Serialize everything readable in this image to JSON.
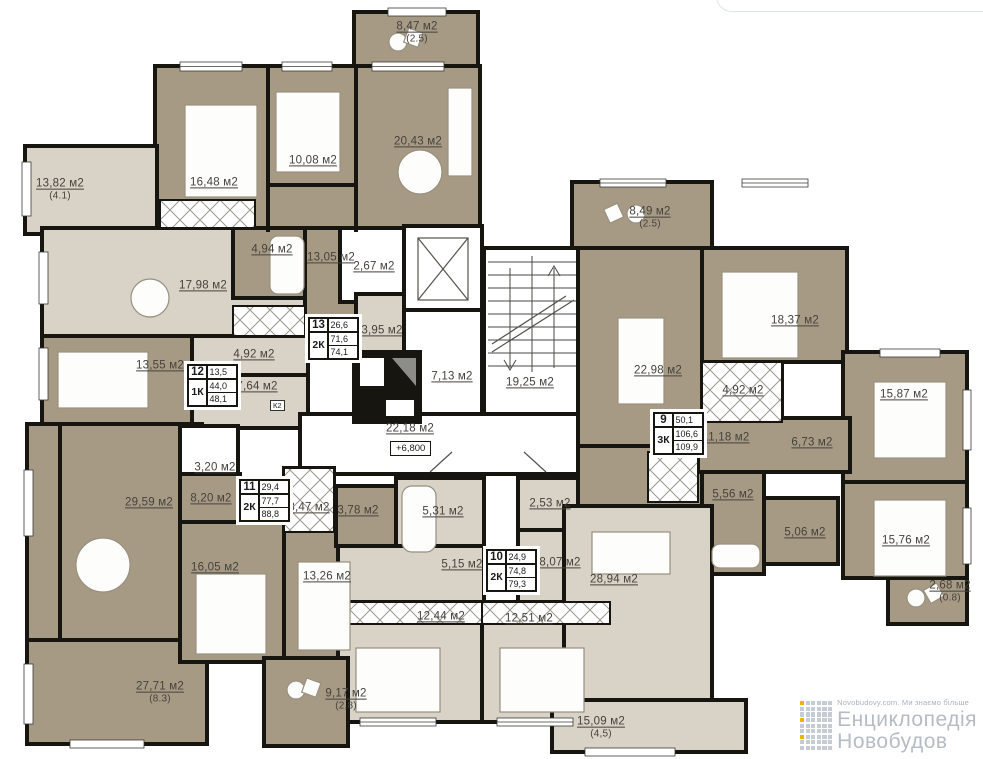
{
  "canvas": {
    "width": 983,
    "height": 759
  },
  "level_marker": "+6,800",
  "rooms": [
    {
      "label": "8,47 м2",
      "sub": "(2.5)",
      "x": 417,
      "y": 33
    },
    {
      "label": "16,48 м2",
      "x": 214,
      "y": 183
    },
    {
      "label": "10,08 м2",
      "x": 313,
      "y": 161
    },
    {
      "label": "20,43 м2",
      "x": 418,
      "y": 142
    },
    {
      "label": "13,82 м2",
      "sub": "(4.1)",
      "x": 60,
      "y": 190
    },
    {
      "label": "17,98 м2",
      "x": 203,
      "y": 286
    },
    {
      "label": "4,94 м2",
      "x": 272,
      "y": 250
    },
    {
      "label": "13,05 м2",
      "x": 331,
      "y": 258
    },
    {
      "label": "2,67 м2",
      "x": 374,
      "y": 267
    },
    {
      "label": "3,95 м2",
      "x": 382,
      "y": 331
    },
    {
      "label": "13,55 м2",
      "x": 160,
      "y": 366
    },
    {
      "label": "4,92 м2",
      "x": 254,
      "y": 355
    },
    {
      "label": "7,64 м2",
      "x": 257,
      "y": 387
    },
    {
      "label": "7,13 м2",
      "x": 452,
      "y": 377
    },
    {
      "label": "19,25 м2",
      "x": 530,
      "y": 383
    },
    {
      "label": "22,18 м2",
      "x": 410,
      "y": 429
    },
    {
      "label": "8,49 м2",
      "sub": "(2.5)",
      "x": 650,
      "y": 218
    },
    {
      "label": "22,98 м2",
      "x": 658,
      "y": 371
    },
    {
      "label": "18,37 м2",
      "x": 795,
      "y": 321
    },
    {
      "label": "4,92 м2",
      "x": 743,
      "y": 391
    },
    {
      "label": "15,87 м2",
      "x": 904,
      "y": 395
    },
    {
      "label": "11,18 м2",
      "x": 726,
      "y": 438
    },
    {
      "label": "6,73 м2",
      "x": 812,
      "y": 443
    },
    {
      "label": "5,56 м2",
      "x": 733,
      "y": 495
    },
    {
      "label": "5,06 м2",
      "x": 805,
      "y": 533
    },
    {
      "label": "15,76 м2",
      "x": 906,
      "y": 541
    },
    {
      "label": "2,68 м2",
      "sub": "(0.8)",
      "x": 950,
      "y": 592
    },
    {
      "label": "29,59 м2",
      "x": 149,
      "y": 503
    },
    {
      "label": "3,20 м2",
      "x": 215,
      "y": 468
    },
    {
      "label": "8,20 м2",
      "x": 211,
      "y": 499
    },
    {
      "label": "3,47 м2",
      "x": 309,
      "y": 508
    },
    {
      "label": "16,05 м2",
      "x": 215,
      "y": 568
    },
    {
      "label": "13,26 м2",
      "x": 327,
      "y": 577
    },
    {
      "label": "3,78 м2",
      "x": 358,
      "y": 511
    },
    {
      "label": "5,31 м2",
      "x": 443,
      "y": 512
    },
    {
      "label": "5,15 м2",
      "x": 462,
      "y": 565
    },
    {
      "label": "2,53 м2",
      "x": 550,
      "y": 504
    },
    {
      "label": "8,07 м2",
      "x": 560,
      "y": 563
    },
    {
      "label": "12,44 м2",
      "x": 441,
      "y": 617
    },
    {
      "label": "12,51 м2",
      "x": 529,
      "y": 619
    },
    {
      "label": "28,94 м2",
      "x": 614,
      "y": 580
    },
    {
      "label": "27,71 м2",
      "sub": "(8.3)",
      "x": 160,
      "y": 693
    },
    {
      "label": "9,17 м2",
      "sub": "(2,8)",
      "x": 346,
      "y": 700
    },
    {
      "label": "15,09 м2",
      "sub": "(4,5)",
      "x": 601,
      "y": 728
    }
  ],
  "small_labels": [
    {
      "text": "К2",
      "x": 270,
      "y": 400
    }
  ],
  "apartment_tables": [
    {
      "number": "13",
      "type": "2К",
      "values": [
        "26,6",
        "71,6",
        "74,1"
      ],
      "x": 308,
      "y": 317
    },
    {
      "number": "12",
      "type": "1К",
      "values": [
        "13,5",
        "44,0",
        "48,1"
      ],
      "x": 187,
      "y": 364
    },
    {
      "number": "11",
      "type": "2К",
      "values": [
        "29,4",
        "77,7",
        "88,8"
      ],
      "x": 239,
      "y": 479
    },
    {
      "number": "10",
      "type": "2К",
      "values": [
        "24,9",
        "74,8",
        "79,3"
      ],
      "x": 486,
      "y": 549
    },
    {
      "number": "9",
      "type": "3К",
      "values": [
        "50,1",
        "106,6",
        "109,9"
      ],
      "x": 653,
      "y": 412
    }
  ],
  "watermark": {
    "tagline": "Novobudovy.com. Ми знаємо більше",
    "line1": "Енциклопедія",
    "line2": "Новобудов"
  },
  "colors": {
    "wall": "#17150f",
    "room_dark": "#a79a85",
    "room_light": "#d9d3c7",
    "label_text": "#45423c",
    "watermark_text": "#b6bcc4",
    "watermark_accent": "#f0b400",
    "watermark_square": "#c6ccd3",
    "card_border": "#dce4ee"
  }
}
